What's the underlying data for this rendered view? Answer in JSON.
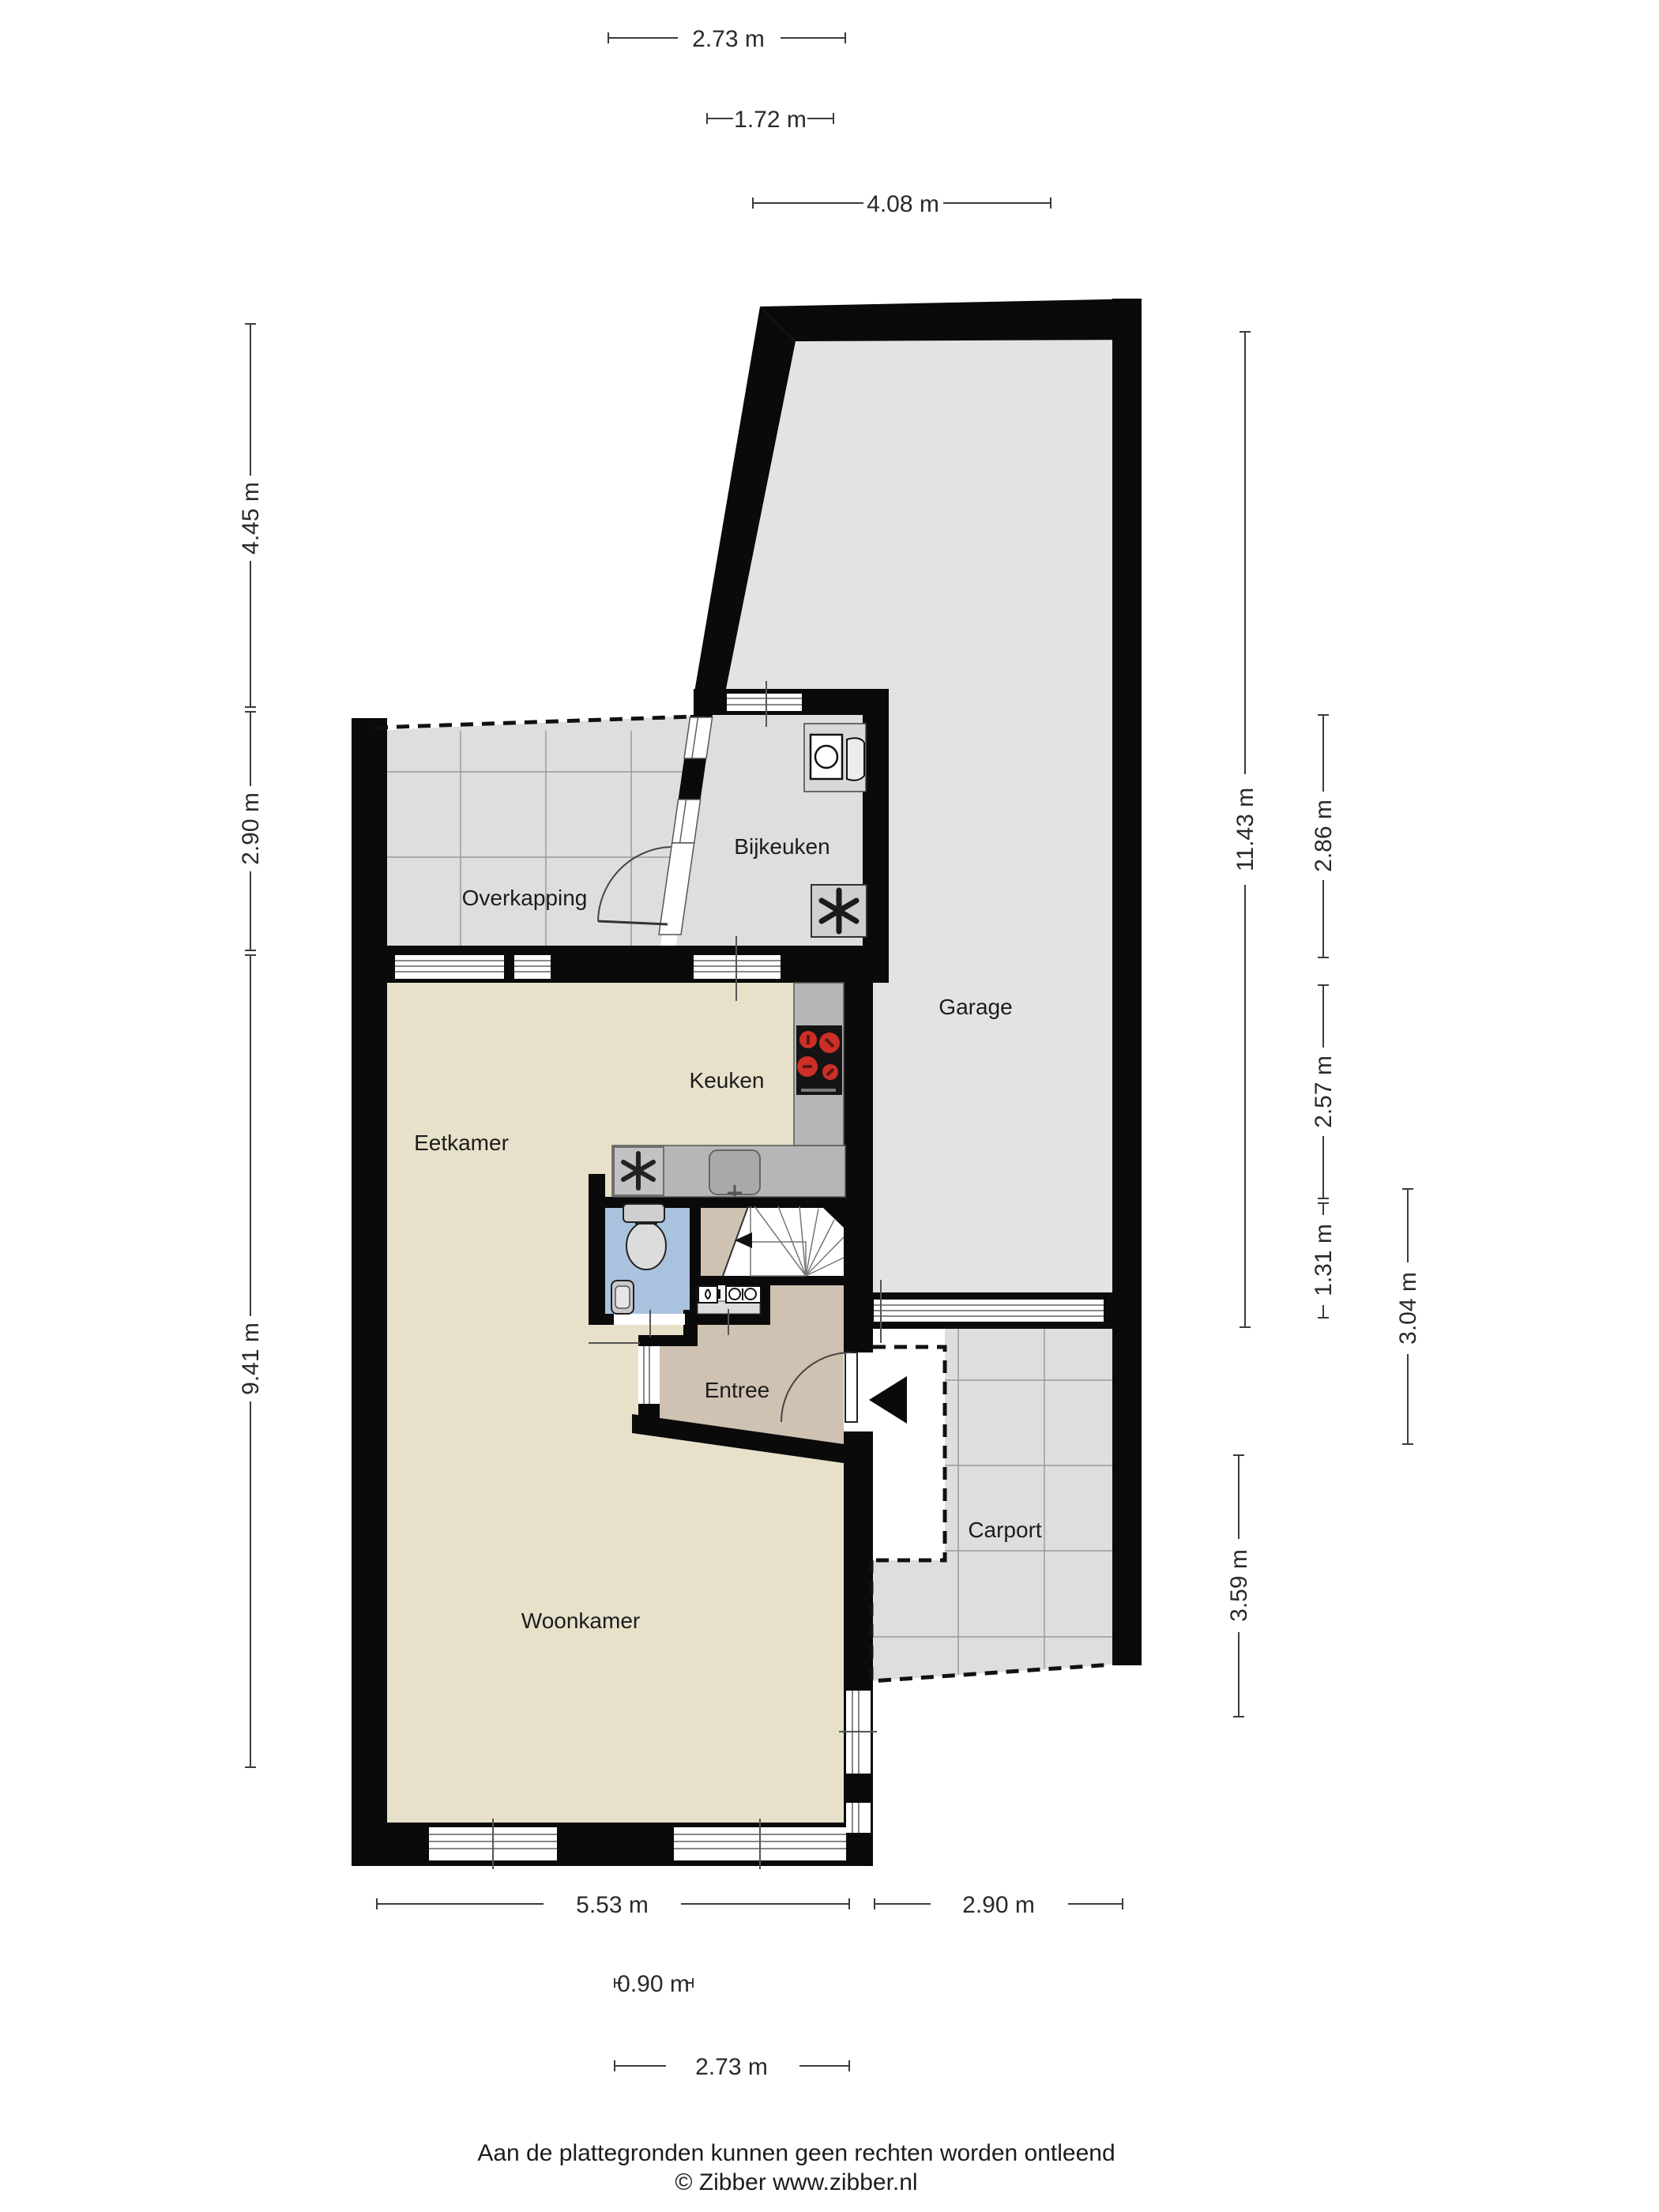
{
  "rooms": {
    "overkapping": {
      "label": "Overkapping"
    },
    "bijkeuken": {
      "label": "Bijkeuken"
    },
    "garage": {
      "label": "Garage"
    },
    "keuken": {
      "label": "Keuken"
    },
    "eetkamer": {
      "label": "Eetkamer"
    },
    "entree": {
      "label": "Entree"
    },
    "woonkamer": {
      "label": "Woonkamer"
    },
    "carport": {
      "label": "Carport"
    }
  },
  "dimensions": {
    "top": [
      {
        "label": "2.73 m"
      },
      {
        "label": "1.72 m"
      },
      {
        "label": "4.08 m"
      }
    ],
    "left": [
      {
        "label": "4.45 m"
      },
      {
        "label": "2.90 m"
      },
      {
        "label": "9.41 m"
      }
    ],
    "right": [
      {
        "label": "11.43 m"
      },
      {
        "label": "2.86 m"
      },
      {
        "label": "2.57 m"
      },
      {
        "label": "1.31 m"
      },
      {
        "label": "3.04 m"
      },
      {
        "label": "3.59 m"
      }
    ],
    "bottom": [
      {
        "label": "5.53 m"
      },
      {
        "label": "2.90 m"
      },
      {
        "label": "0.90 m"
      },
      {
        "label": "2.73 m"
      }
    ]
  },
  "footer": {
    "disclaimer": "Aan de plattegronden kunnen geen rechten worden ontleend",
    "credit": "© Zibber www.zibber.nl"
  },
  "colors": {
    "wall": "#0a0a0a",
    "floor_living": "#e8e1ca",
    "floor_hall": "#cfc2b2",
    "floor_toilet": "#a9c2de",
    "floor_garage": "#e3e3e3",
    "floor_tiles": "#dedede",
    "grid_line": "#9a9a9a",
    "counter": "#b6b6b6",
    "burner_red": "#cc2f26",
    "dimension_line": "#3c3c3c"
  },
  "icons": {
    "washing_machine": "washing-machine-icon",
    "ventilation_fan": "fan-icon",
    "stove": "stove-icon",
    "kitchen_sink": "sink-icon",
    "toilet": "toilet-icon",
    "hand_basin": "hand-basin-icon",
    "stairs_arrow": "stairs-direction-arrow-icon",
    "entrance_arrow": "entrance-arrow-icon",
    "water_meter": "water-connection-icon",
    "electric_meter": "electric-panel-icon"
  }
}
